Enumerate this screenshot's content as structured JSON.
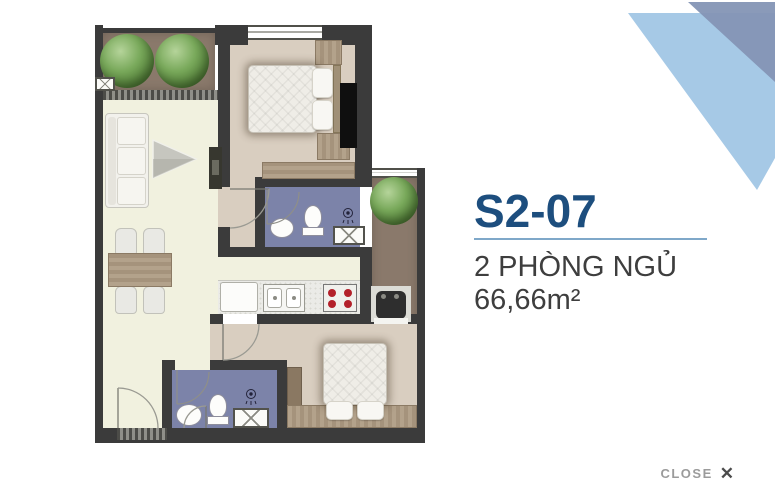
{
  "panel": {
    "unit_code": "S2-07",
    "bedrooms": "2 PHÒNG NGỦ",
    "area": "66,66m²"
  },
  "close": {
    "label": "CLOSE",
    "icon": "✕"
  },
  "colors": {
    "title_blue": "#1d4e7e",
    "divider_blue": "#7fa8c9",
    "text_gray": "#3e3e3e",
    "close_gray": "#9b9b9b",
    "corner_triangle_light": "#a6c9e6",
    "corner_triangle_dark": "#8495b5",
    "wall": "#3b3b3b",
    "floor_living": "#f1f1df",
    "floor_bedroom": "#d9cec0",
    "floor_bathroom": "#7c83a9",
    "floor_balcony": "#8a796b"
  }
}
